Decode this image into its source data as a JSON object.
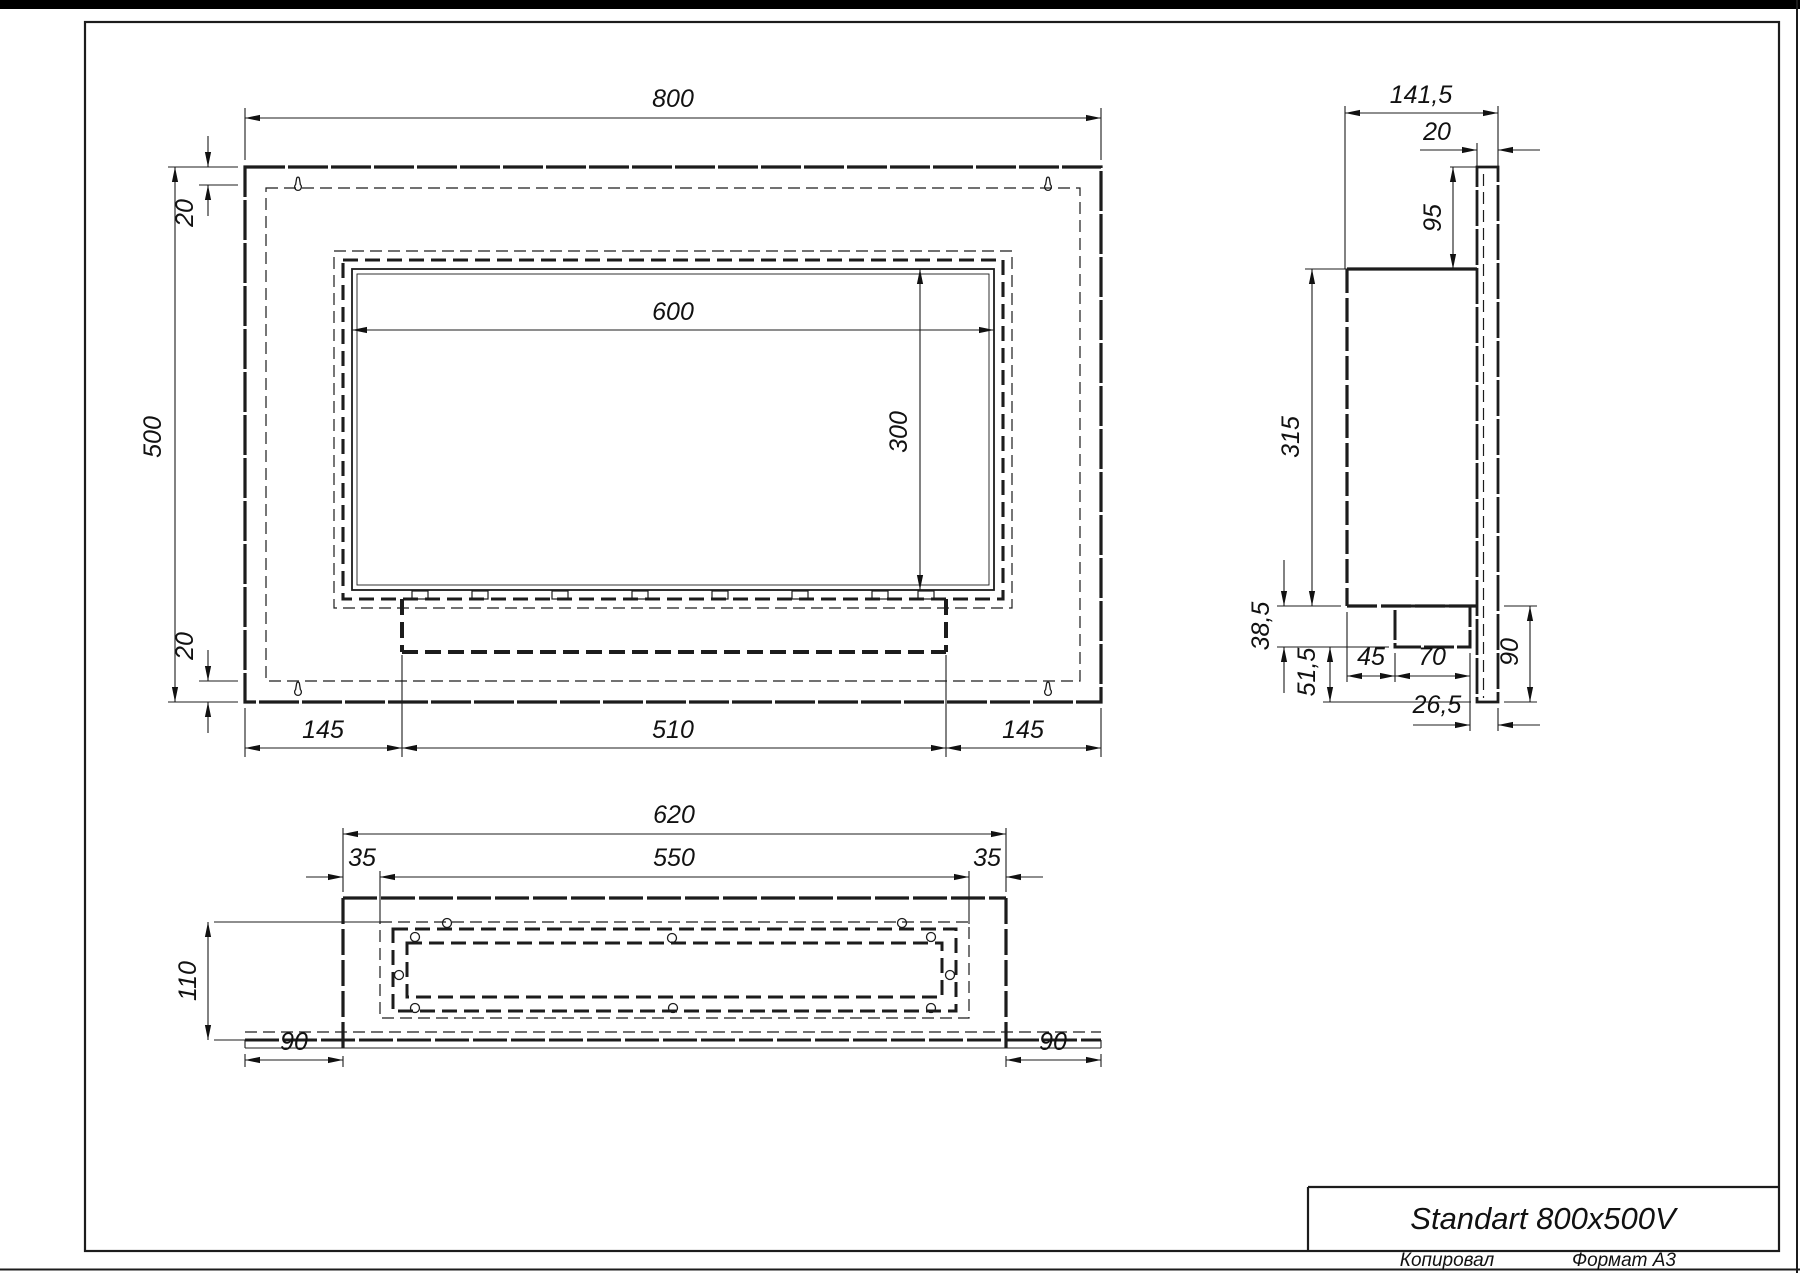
{
  "page": {
    "title": "Standart 800x500V",
    "footer": {
      "copied": "Копировал",
      "format": "Формат А3"
    }
  },
  "views": {
    "front": {
      "label": "front-view",
      "dims": {
        "width": "800",
        "top_offset": "20",
        "height": "500",
        "bottom_offset": "20",
        "opening_width": "600",
        "opening_height": "300",
        "margin_left": "145",
        "tray_width": "510",
        "margin_right": "145"
      }
    },
    "side": {
      "label": "side-view",
      "dims": {
        "depth": "141,5",
        "plate_thickness": "20",
        "top_to_opening": "95",
        "box_height": "315",
        "burner_depth": "38,5",
        "under_burner": "51,5",
        "front_to_burner": "45",
        "burner_width": "70",
        "lower_height": "90",
        "back_gap": "26,5"
      }
    },
    "bottom": {
      "label": "bottom-view",
      "dims": {
        "box_width": "620",
        "slot_inset_left": "35",
        "slot_width": "550",
        "slot_inset_right": "35",
        "depth": "110",
        "flange_left": "90",
        "flange_right": "90"
      }
    }
  }
}
